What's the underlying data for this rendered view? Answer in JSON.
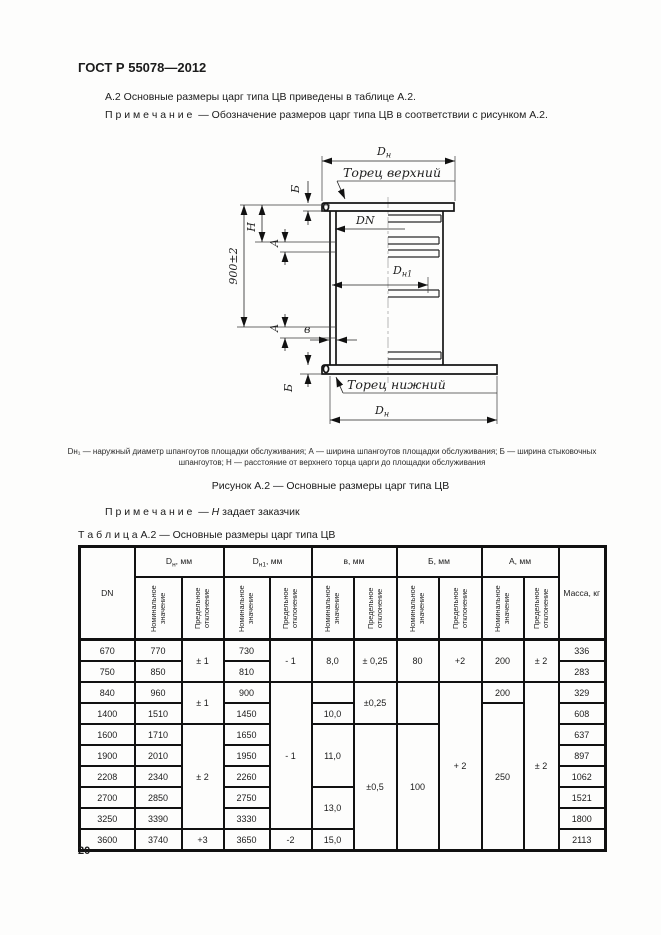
{
  "page": {
    "header_title": "ГОСТ Р 55078—2012",
    "page_number": "20"
  },
  "intro": {
    "line1": "А.2 Основные размеры царг типа ЦВ приведены в таблице А.2.",
    "note_label": "П р и м е ч а н и е",
    "note_text": "— Обозначение размеров царг типа ЦВ в соответствии с рисунком А.2."
  },
  "figure": {
    "labels": {
      "dn_top": {
        "main": "D",
        "sub": "н"
      },
      "top_face": "Торец верхний",
      "dn": "DN",
      "dn1": {
        "main": "D",
        "sub": "н1"
      },
      "b_top": "Б",
      "h": "H",
      "dim900": "900±2",
      "a_top": "А",
      "a_bottom": "А",
      "v": "в",
      "b_bottom": "Б",
      "bottom_face": "Торец нижний",
      "dn_bottom": {
        "main": "D",
        "sub": "н"
      }
    },
    "caption_def": "Dн₁ — наружный диаметр шпангоутов площадки обслуживания; А — ширина шпангоутов площадки обслуживания; Б — ширина стыковочных шпангоутов; Н — расстояние от верхнего торца царги до площадки обслуживания",
    "caption": "Рисунок А.2 — Основные размеры царг типа ЦВ",
    "note_label": "П р и м е ч а н и е",
    "note_dash": "—",
    "note_var": "Н",
    "note_text": "задает заказчик"
  },
  "table": {
    "title_label": "Т а б л и ц а  А.2",
    "title_rest": "— Основные размеры царг типа ЦВ",
    "col_dn": "DN",
    "col_mass": "Масса, кг",
    "sub_nominal": "Номинальное значение",
    "sub_deviation": "Предельное отклонение",
    "groups": [
      {
        "main": "D",
        "sub": "н",
        "unit": ", мм"
      },
      {
        "main": "D",
        "sub": "н1",
        "unit": ", мм"
      },
      {
        "main": "в",
        "sub": "",
        "unit": ", мм"
      },
      {
        "main": "Б",
        "sub": "",
        "unit": ", мм"
      },
      {
        "main": "А",
        "sub": "",
        "unit": ", мм"
      }
    ],
    "rows": [
      {
        "dn": "670",
        "dn_nom": "770",
        "dn_dev": "± 1",
        "dn1_nom": "730",
        "dn1_dev": "- 1",
        "v_nom": "8,0",
        "v_dev": "± 0,25",
        "b_nom": "80",
        "b_dev": "+2",
        "a_nom": "200",
        "a_dev": "± 2",
        "mass": "336"
      },
      {
        "dn": "750",
        "dn_nom": "850",
        "dn1_nom": "810",
        "mass": "283"
      },
      {
        "dn": "840",
        "dn_nom": "960",
        "dn_dev": "± 1",
        "dn1_nom": "900",
        "dn1_dev": "- 1",
        "v_nom": "",
        "v_dev": "±0,25",
        "b_nom": "",
        "b_dev": "+ 2",
        "a_nom": "200",
        "a_dev": "± 2",
        "mass": "329"
      },
      {
        "dn": "1400",
        "dn_nom": "1510",
        "dn1_nom": "1450",
        "v_nom": "10,0",
        "a_nom": "250",
        "mass": "608"
      },
      {
        "dn": "1600",
        "dn_nom": "1710",
        "dn_dev": "± 2",
        "dn1_nom": "1650",
        "v_nom": "11,0",
        "v_dev": "±0,5",
        "b_nom": "100",
        "mass": "637"
      },
      {
        "dn": "1900",
        "dn_nom": "2010",
        "dn1_nom": "1950",
        "mass": "897"
      },
      {
        "dn": "2208",
        "dn_nom": "2340",
        "dn1_nom": "2260",
        "mass": "1062"
      },
      {
        "dn": "2700",
        "dn_nom": "2850",
        "dn1_nom": "2750",
        "v_nom": "13,0",
        "mass": "1521"
      },
      {
        "dn": "3250",
        "dn_nom": "3390",
        "dn1_nom": "3330",
        "mass": "1800"
      },
      {
        "dn": "3600",
        "dn_nom": "3740",
        "dn_dev": "+3",
        "dn1_nom": "3650",
        "dn1_dev": "-2",
        "v_nom": "15,0",
        "mass": "2113"
      }
    ]
  }
}
